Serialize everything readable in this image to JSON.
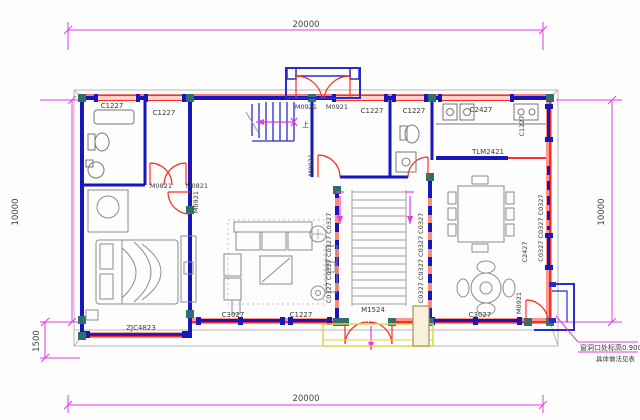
{
  "drawing": {
    "type": "architectural-floor-plan",
    "dims": {
      "top": "20000",
      "bottom": "20000",
      "left": "10000",
      "right": "10000",
      "offset_bottom_left": "1500"
    },
    "windows": {
      "c1227": "C1227",
      "c2427": "C2427",
      "c3027": "C3027",
      "c0327_x4": "C0327 C0327 C0327 C0327",
      "c0327_x3": "C0327 C0327 C0327",
      "corner_window": "ZJC4823",
      "sliding_door": "TLM2421"
    },
    "doors": {
      "m0921": "M0921",
      "m0821": "M0821",
      "m1524": "M1524"
    },
    "stair_up": "上",
    "note": {
      "line1": "窗洞口处标高0.900",
      "line2": "具体做法见表"
    },
    "colors": {
      "wall_blue": "#1717bb",
      "window_red": "#ff2d20",
      "dimension_magenta": "#e23ce2",
      "column_teal": "#2e6f6f",
      "furniture_gray": "#8c8c8c",
      "porch_yellow": "#d8d84a"
    }
  }
}
